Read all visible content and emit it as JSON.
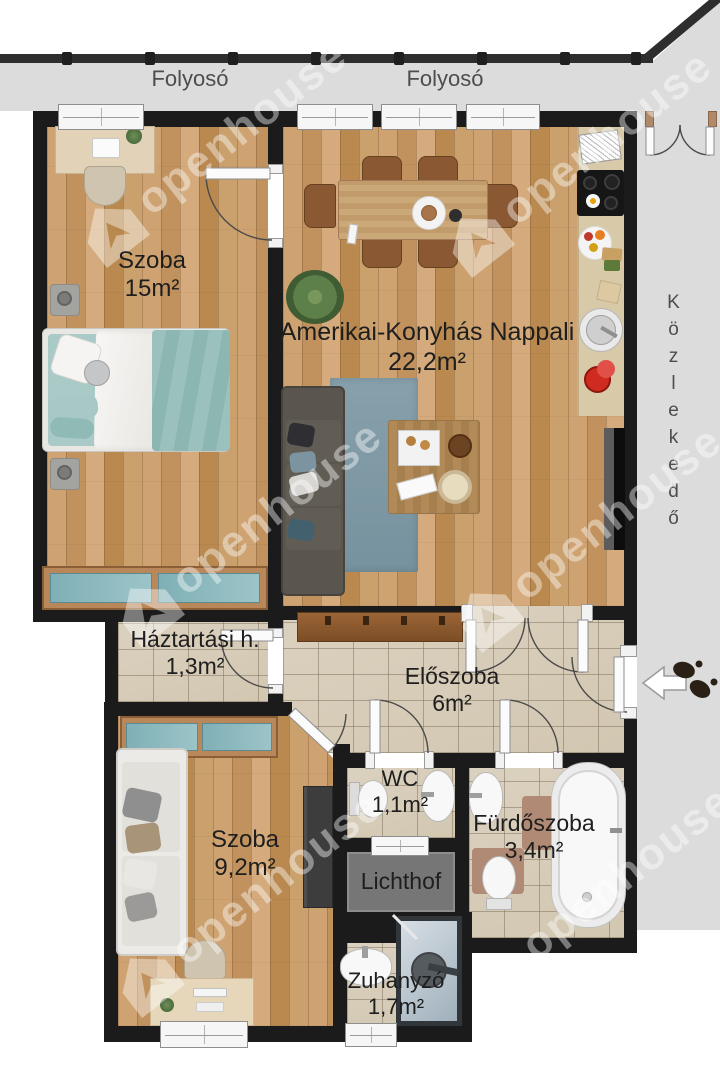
{
  "corridors": {
    "top_label_1": "Folyosó",
    "top_label_2": "Folyosó",
    "right_label": "Közlekedő"
  },
  "rooms": {
    "bedroom": {
      "name": "Szoba",
      "area": "15m²"
    },
    "living": {
      "name": "Amerikai-Konyhás Nappali",
      "area": "22,2m²"
    },
    "household": {
      "name": "Háztartási h.",
      "area": "1,3m²"
    },
    "hall": {
      "name": "Előszoba",
      "area": "6m²"
    },
    "wc": {
      "name": "WC",
      "area": "1,1m²"
    },
    "bathroom": {
      "name": "Fürdőszoba",
      "area": "3,4m²"
    },
    "lichthof": {
      "name": "Lichthof"
    },
    "shower": {
      "name": "Zuhanyzó",
      "area": "1,7m²"
    },
    "small_room": {
      "name": "Szoba",
      "area": "9,2m²"
    }
  },
  "watermark": {
    "text": "openhouse",
    "logo_icon": "house-logo"
  },
  "icons": {
    "entrance_arrow": "left-arrow",
    "footprints": "footprints"
  },
  "colors": {
    "wall": "#1b1b1b",
    "wood": "#c89a66",
    "tile": "#d9cfbe",
    "corridor_bg": "#dcdcdc",
    "lichthof_bg": "#767676",
    "accent_teal": "#8fbcba",
    "label_text": "#1e1e1e"
  }
}
